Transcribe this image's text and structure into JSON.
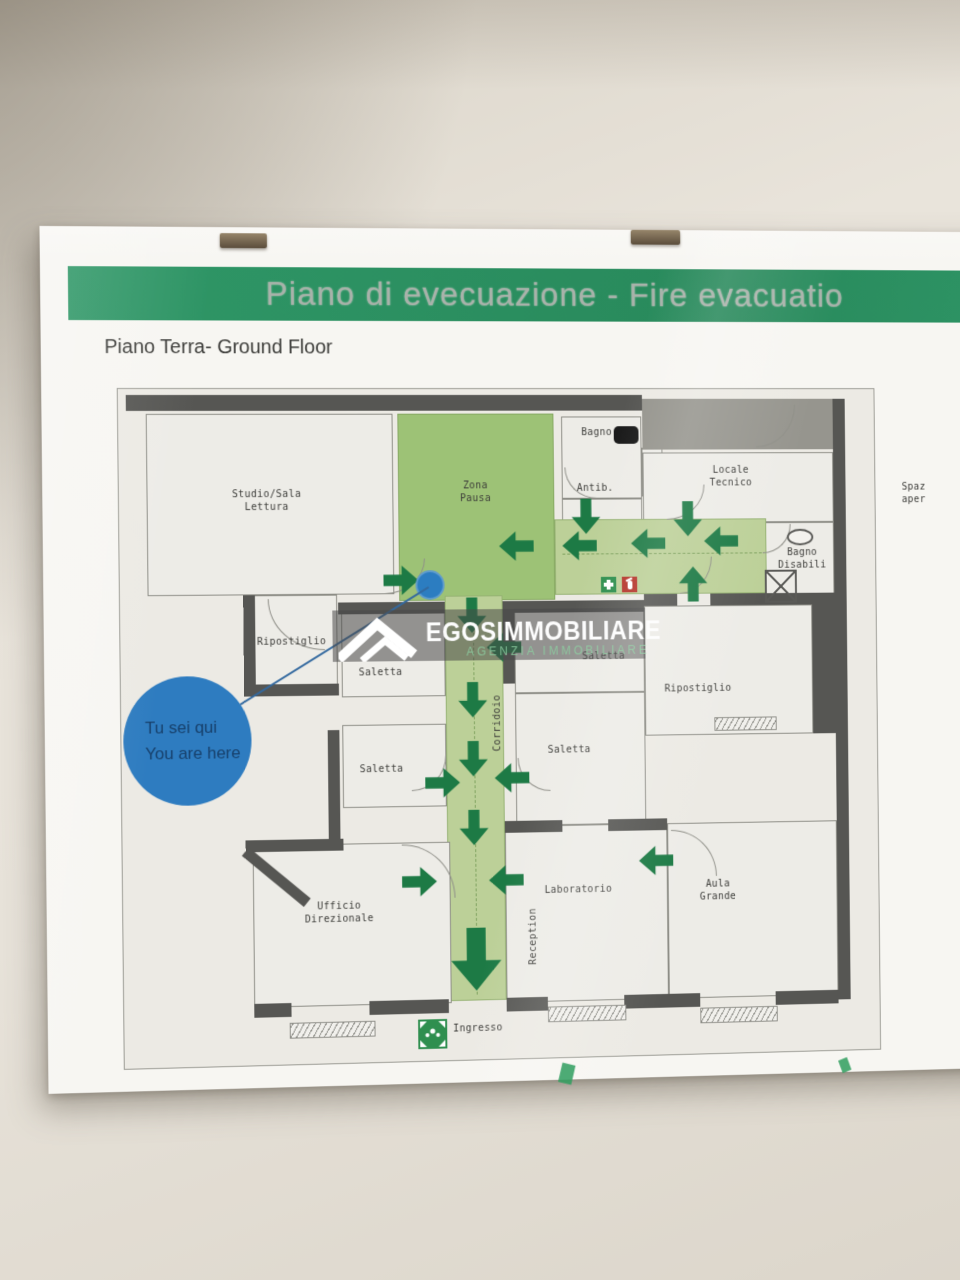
{
  "poster": {
    "banner_title": "Piano di evecuazione - Fire evacuatio",
    "floor_label": "Piano Terra- Ground Floor",
    "logo": {
      "name": "EGOSIMMOBILIARE",
      "tagline": "AGENZIA IMMOBILIARE"
    },
    "you_are_here": "Tu sei qui\nYou are here"
  },
  "rooms": {
    "studio_sala_lettura": "Studio/Sala\nLettura",
    "zona_pausa": "Zona\nPausa",
    "bagno": "Bagno",
    "antibagno": "Antib.",
    "locale_tecnico": "Locale\nTecnico",
    "bagno_disabili": "Bagno\nDisabili",
    "spazio_aperto_cut": "Spaz\naper",
    "ripostiglio_sx": "Ripostiglio",
    "saletta_nw": "Saletta",
    "saletta_w": "Saletta",
    "saletta_c": "Saletta",
    "saletta_cs": "Saletta",
    "corridoio": "Corridoio",
    "ripostiglio_dx": "Ripostiglio",
    "ufficio_direzionale": "Ufficio\nDirezionale",
    "laboratorio": "Laboratorio",
    "reception": "Reception",
    "aula_grande": "Aula\nGrande",
    "ingresso": "Ingresso"
  },
  "icons": {
    "first_aid": "first-aid-icon",
    "fire_extinguisher": "fire-extinguisher-icon",
    "assembly_point": "assembly-point-icon",
    "house_logo": "house-logo-icon",
    "toilet": "toilet-icon",
    "shower": "shower-icon",
    "frame_clip": "frame-clip"
  },
  "colors": {
    "banner_green": "#2e9465",
    "route_green": "#bcd098",
    "zone_green": "#9dc276",
    "arrow_green": "#1d7a45",
    "marker_blue": "#2c7dc1",
    "wall_gray": "#565653"
  }
}
